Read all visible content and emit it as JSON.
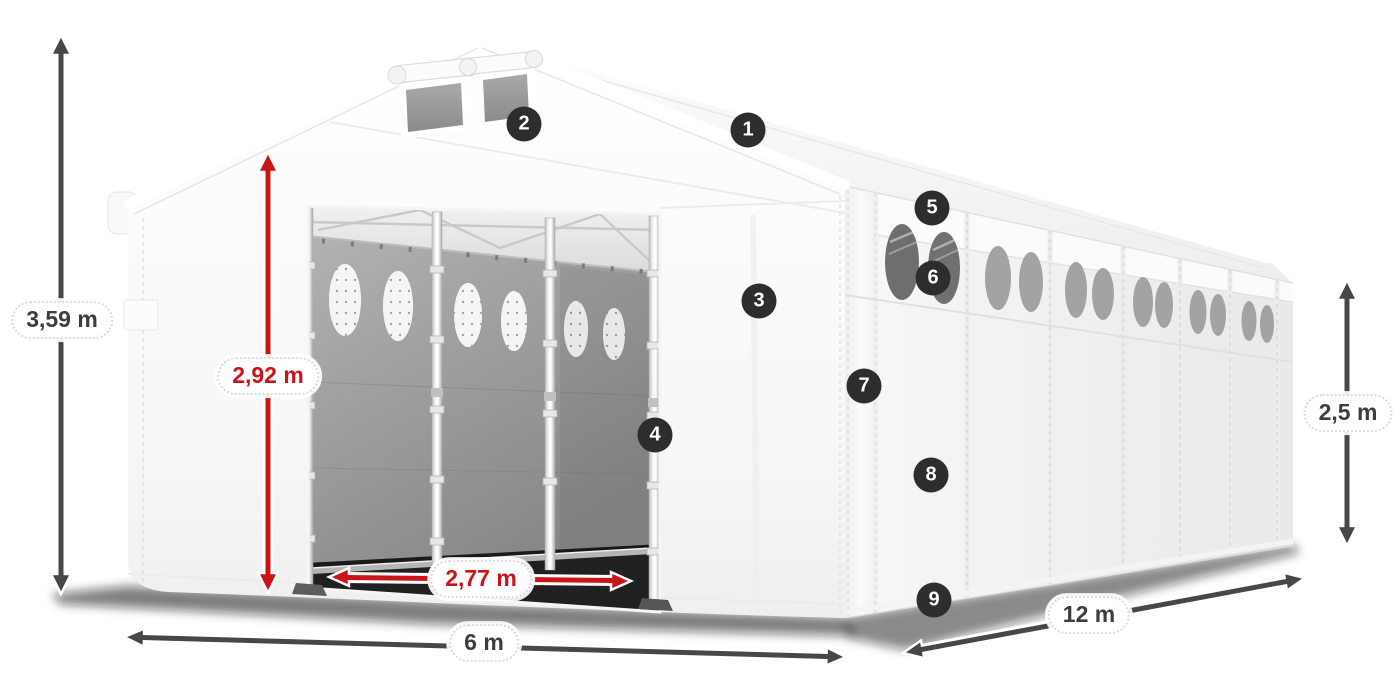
{
  "dimensions": {
    "total_height": {
      "value": "3,59 m",
      "color": "#3d3d3d"
    },
    "door_height": {
      "value": "2,92 m",
      "color": "#cc1418"
    },
    "door_width": {
      "value": "2,77 m",
      "color": "#cc1418"
    },
    "front_width": {
      "value": "6 m",
      "color": "#3d3d3d"
    },
    "side_length": {
      "value": "12 m",
      "color": "#3d3d3d"
    },
    "side_height": {
      "value": "2,5 m",
      "color": "#3d3d3d"
    }
  },
  "callouts": [
    {
      "number": "1"
    },
    {
      "number": "2"
    },
    {
      "number": "3"
    },
    {
      "number": "4"
    },
    {
      "number": "5"
    },
    {
      "number": "6"
    },
    {
      "number": "7"
    },
    {
      "number": "8"
    },
    {
      "number": "9"
    }
  ],
  "colors": {
    "dimension_red": "#cc1418",
    "dimension_dark": "#474747",
    "callout_background": "#2d2d2d",
    "callout_text": "#ffffff",
    "tent_fabric": "#ffffff",
    "interior_curtain": "#9a9a9a"
  }
}
